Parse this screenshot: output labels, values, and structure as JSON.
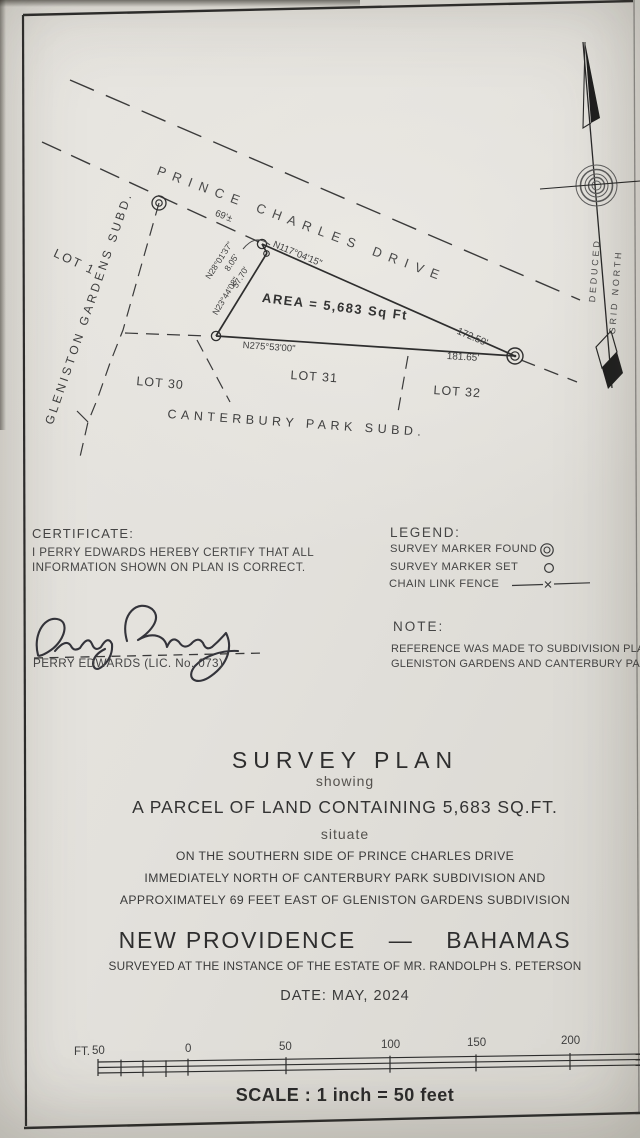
{
  "colors": {
    "paper": "#e4e2dd",
    "ink": "#3a3a3a",
    "border": "#2c2c2c"
  },
  "drawing": {
    "road_name": "P R I N C E   C H A R L E S   D R I V E",
    "area_label": "AREA = 5,683 Sq Ft",
    "frontage_offset": "69'±",
    "bearing_road": "N117°04'15\"",
    "distance_road": "172.59'",
    "bearing_south": "N275°53'00\"",
    "distance_south": "181.65'",
    "bearing_west": "N23°44'08\"",
    "distance_west": "57.70'",
    "bearing_tie": "N28°01'37\"",
    "distance_tie": "8.05'",
    "lot_1": "LOT 1",
    "lot_30": "LOT 30",
    "lot_31": "LOT 31",
    "lot_32": "LOT 32",
    "subdivision_west": "GLENISTON GARDENS SUBD.",
    "subdivision_south": "CANTERBURY PARK SUBD.",
    "north_arrow_left": "DEDUCED",
    "north_arrow_right": "GRID NORTH"
  },
  "certificate": {
    "heading": "CERTIFICATE:",
    "line1": "I PERRY EDWARDS HEREBY CERTIFY THAT ALL",
    "line2": "INFORMATION SHOWN ON PLAN IS CORRECT.",
    "signed_name": "PERRY EDWARDS (LIC. No. 073)"
  },
  "legend": {
    "heading": "LEGEND:",
    "items": [
      {
        "label": "SURVEY MARKER FOUND",
        "symbol": "double-circle"
      },
      {
        "label": "SURVEY MARKER SET",
        "symbol": "single-circle"
      },
      {
        "label": "CHAIN LINK FENCE",
        "symbol": "line-x-line"
      }
    ]
  },
  "note": {
    "heading": "NOTE:",
    "line1": "REFERENCE WAS MADE TO SUBDIVISION PLANS",
    "line2": "GLENISTON GARDENS AND CANTERBURY PARK"
  },
  "title_block": {
    "title": "SURVEY PLAN",
    "showing": "showing",
    "parcel": "A PARCEL OF LAND CONTAINING 5,683 SQ.FT.",
    "situate": "situate",
    "location_line1": "ON THE SOUTHERN SIDE OF PRINCE CHARLES DRIVE",
    "location_line2": "IMMEDIATELY NORTH OF CANTERBURY PARK SUBDIVISION AND",
    "location_line3": "APPROXIMATELY 69 FEET EAST OF GLENISTON GARDENS SUBDIVISION",
    "jurisdiction": "NEW PROVIDENCE    —    BAHAMAS",
    "surveyed_for": "SURVEYED AT THE INSTANCE OF THE ESTATE OF MR. RANDOLPH S. PETERSON",
    "date_line": "DATE: MAY, 2024"
  },
  "scale_bar": {
    "unit": "FT.",
    "ticks": [
      "50",
      "0",
      "50",
      "100",
      "150",
      "200"
    ],
    "caption": "SCALE : 1 inch = 50 feet"
  }
}
